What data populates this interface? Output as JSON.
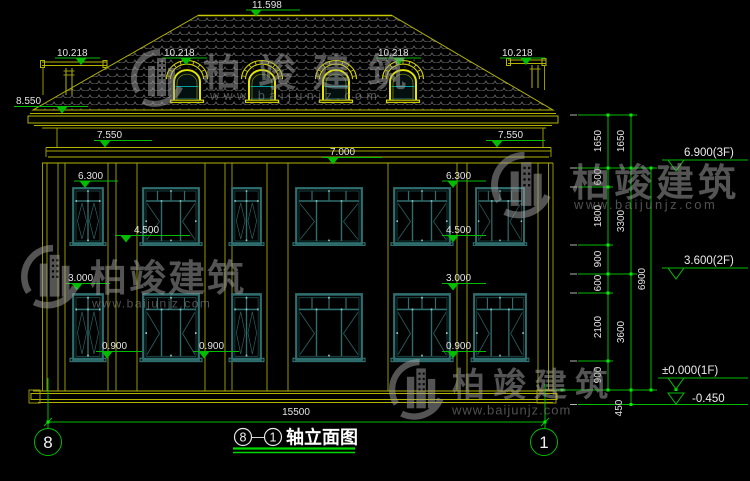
{
  "watermark": {
    "brand": "柏竣建筑",
    "url": "www.baijunjz.com"
  },
  "title": {
    "axis_start": "8",
    "dash": "—",
    "axis_end": "1",
    "name": "轴立面图"
  },
  "axis_bubbles": {
    "left": "8",
    "right": "1"
  },
  "dims": {
    "ridge": "11.598",
    "roof": "10.218",
    "eave": "8.550",
    "cornice": "7.550",
    "wall_top": "7.000",
    "win2_top": "6.300",
    "win2_sill": "4.500",
    "win1_top": "3.000",
    "win1_sill": "0.900",
    "total_width": "15500"
  },
  "chain": {
    "v1650": "1650",
    "v600": "600",
    "v1800": "1800",
    "v900": "900",
    "v2100": "2100",
    "v3300": "3300",
    "v3600": "3600",
    "v6900": "6900",
    "v450": "450"
  },
  "levels": {
    "f3": "6.900(3F)",
    "f2": "3.600(2F)",
    "f1": "±0.000(1F)",
    "below": "-0.450"
  }
}
